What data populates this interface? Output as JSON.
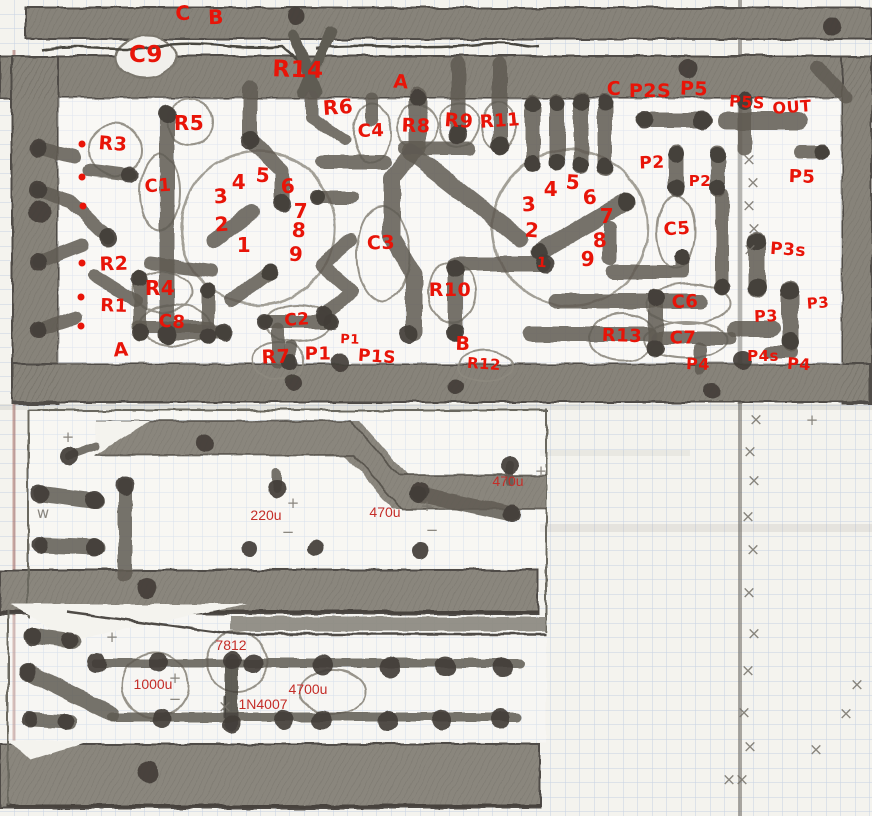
{
  "meta": {
    "description": "Hand-drawn PCB copper trace layout sketch on blue graph paper, pencil traces with red component annotations"
  },
  "colors": {
    "paper": "#f4f3ee",
    "grid_blue": "#b7c6df",
    "pencil_gray": "#5f5b52",
    "pencil_dark": "#423e38",
    "handwritten_red": "#e81408",
    "typed_red": "#c42d28",
    "margin_line": "#9b5a50"
  },
  "component_labels": [
    {
      "text": "C",
      "x": 183,
      "y": 13,
      "size": 20
    },
    {
      "text": "B",
      "x": 216,
      "y": 17,
      "size": 20
    },
    {
      "text": "C9",
      "x": 146,
      "y": 55,
      "size": 23
    },
    {
      "text": "R14",
      "x": 298,
      "y": 70,
      "size": 23
    },
    {
      "text": "A",
      "x": 401,
      "y": 82,
      "size": 19
    },
    {
      "text": "R6",
      "x": 338,
      "y": 107,
      "size": 20
    },
    {
      "text": "C4",
      "x": 371,
      "y": 131,
      "size": 18
    },
    {
      "text": "R5",
      "x": 189,
      "y": 123,
      "size": 20
    },
    {
      "text": "R8",
      "x": 416,
      "y": 126,
      "size": 19
    },
    {
      "text": "R9",
      "x": 459,
      "y": 121,
      "size": 19
    },
    {
      "text": "R11",
      "x": 500,
      "y": 121,
      "size": 18
    },
    {
      "text": "C",
      "x": 614,
      "y": 89,
      "size": 19
    },
    {
      "text": "P2S",
      "x": 650,
      "y": 91,
      "size": 19
    },
    {
      "text": "P5",
      "x": 694,
      "y": 89,
      "size": 19
    },
    {
      "text": "P5S",
      "x": 747,
      "y": 102,
      "size": 16
    },
    {
      "text": "OUT",
      "x": 792,
      "y": 107,
      "size": 16
    },
    {
      "text": "P2",
      "x": 652,
      "y": 163,
      "size": 17
    },
    {
      "text": "P2",
      "x": 700,
      "y": 181,
      "size": 15
    },
    {
      "text": "P5",
      "x": 802,
      "y": 177,
      "size": 18
    },
    {
      "text": "R3",
      "x": 113,
      "y": 144,
      "size": 19
    },
    {
      "text": "C1",
      "x": 158,
      "y": 186,
      "size": 18
    },
    {
      "text": "R2",
      "x": 114,
      "y": 264,
      "size": 19
    },
    {
      "text": "R4",
      "x": 160,
      "y": 288,
      "size": 20
    },
    {
      "text": "R1",
      "x": 114,
      "y": 306,
      "size": 18
    },
    {
      "text": "C8",
      "x": 172,
      "y": 322,
      "size": 18
    },
    {
      "text": "A",
      "x": 121,
      "y": 350,
      "size": 19
    },
    {
      "text": "R7",
      "x": 276,
      "y": 357,
      "size": 19
    },
    {
      "text": "P1",
      "x": 318,
      "y": 354,
      "size": 18
    },
    {
      "text": "P1",
      "x": 350,
      "y": 340,
      "size": 13
    },
    {
      "text": "P1S",
      "x": 377,
      "y": 357,
      "size": 17
    },
    {
      "text": "C2",
      "x": 297,
      "y": 320,
      "size": 17
    },
    {
      "text": "C3",
      "x": 381,
      "y": 243,
      "size": 19
    },
    {
      "text": "R10",
      "x": 450,
      "y": 290,
      "size": 19
    },
    {
      "text": "B",
      "x": 463,
      "y": 344,
      "size": 19
    },
    {
      "text": "R12",
      "x": 484,
      "y": 364,
      "size": 15
    },
    {
      "text": "C5",
      "x": 677,
      "y": 229,
      "size": 18
    },
    {
      "text": "C6",
      "x": 685,
      "y": 302,
      "size": 18
    },
    {
      "text": "C7",
      "x": 683,
      "y": 338,
      "size": 18
    },
    {
      "text": "R13",
      "x": 622,
      "y": 336,
      "size": 18
    },
    {
      "text": "P3s",
      "x": 788,
      "y": 250,
      "size": 17
    },
    {
      "text": "P3",
      "x": 818,
      "y": 303,
      "size": 15
    },
    {
      "text": "P3",
      "x": 766,
      "y": 316,
      "size": 16
    },
    {
      "text": "P4s",
      "x": 763,
      "y": 356,
      "size": 15
    },
    {
      "text": "P4",
      "x": 698,
      "y": 364,
      "size": 16
    },
    {
      "text": "P4",
      "x": 799,
      "y": 364,
      "size": 16
    }
  ],
  "pin_labels": [
    {
      "text": "3",
      "x": 221,
      "y": 196
    },
    {
      "text": "4",
      "x": 239,
      "y": 182
    },
    {
      "text": "5",
      "x": 263,
      "y": 175
    },
    {
      "text": "6",
      "x": 288,
      "y": 186
    },
    {
      "text": "7",
      "x": 301,
      "y": 211
    },
    {
      "text": "8",
      "x": 299,
      "y": 230
    },
    {
      "text": "2",
      "x": 222,
      "y": 224
    },
    {
      "text": "1",
      "x": 244,
      "y": 245
    },
    {
      "text": "9",
      "x": 296,
      "y": 254
    },
    {
      "text": "3",
      "x": 529,
      "y": 204
    },
    {
      "text": "4",
      "x": 551,
      "y": 189
    },
    {
      "text": "5",
      "x": 573,
      "y": 182
    },
    {
      "text": "6",
      "x": 590,
      "y": 197
    },
    {
      "text": "7",
      "x": 607,
      "y": 216
    },
    {
      "text": "2",
      "x": 532,
      "y": 230
    },
    {
      "text": "8",
      "x": 600,
      "y": 240
    },
    {
      "text": "9",
      "x": 588,
      "y": 259
    },
    {
      "text": "1",
      "x": 542,
      "y": 263,
      "size": 14
    }
  ],
  "value_labels": [
    {
      "text": "470u",
      "x": 508,
      "y": 481
    },
    {
      "text": "220u",
      "x": 266,
      "y": 515
    },
    {
      "text": "470u",
      "x": 385,
      "y": 512
    },
    {
      "text": "7812",
      "x": 231,
      "y": 645
    },
    {
      "text": "1000u",
      "x": 153,
      "y": 684
    },
    {
      "text": "4700u",
      "x": 308,
      "y": 689
    },
    {
      "text": "1N4007",
      "x": 263,
      "y": 704
    }
  ],
  "red_dots": [
    {
      "x": 82,
      "y": 144
    },
    {
      "x": 82,
      "y": 177
    },
    {
      "x": 83,
      "y": 206
    },
    {
      "x": 82,
      "y": 263
    },
    {
      "x": 81,
      "y": 297
    },
    {
      "x": 81,
      "y": 326
    }
  ],
  "pencil_marks": [
    {
      "glyph": "+",
      "x": 68,
      "y": 437
    },
    {
      "glyph": "+",
      "x": 293,
      "y": 503
    },
    {
      "glyph": "+",
      "x": 427,
      "y": 506
    },
    {
      "glyph": "+",
      "x": 541,
      "y": 471
    },
    {
      "glyph": "+",
      "x": 175,
      "y": 678
    },
    {
      "glyph": "+",
      "x": 112,
      "y": 637
    },
    {
      "glyph": "−",
      "x": 288,
      "y": 532
    },
    {
      "glyph": "−",
      "x": 432,
      "y": 530
    },
    {
      "glyph": "−",
      "x": 175,
      "y": 699
    },
    {
      "glyph": "w",
      "x": 43,
      "y": 513
    },
    {
      "glyph": "×",
      "x": 225,
      "y": 707
    },
    {
      "glyph": "×",
      "x": 749,
      "y": 160
    },
    {
      "glyph": "×",
      "x": 753,
      "y": 183
    },
    {
      "glyph": "×",
      "x": 749,
      "y": 206
    },
    {
      "glyph": "×",
      "x": 754,
      "y": 229
    },
    {
      "glyph": "×",
      "x": 750,
      "y": 250
    },
    {
      "glyph": "×",
      "x": 757,
      "y": 272
    },
    {
      "glyph": "×",
      "x": 756,
      "y": 420
    },
    {
      "glyph": "×",
      "x": 750,
      "y": 452
    },
    {
      "glyph": "×",
      "x": 754,
      "y": 481
    },
    {
      "glyph": "×",
      "x": 748,
      "y": 517
    },
    {
      "glyph": "×",
      "x": 753,
      "y": 550
    },
    {
      "glyph": "×",
      "x": 749,
      "y": 593
    },
    {
      "glyph": "×",
      "x": 754,
      "y": 634
    },
    {
      "glyph": "×",
      "x": 748,
      "y": 671
    },
    {
      "glyph": "×",
      "x": 744,
      "y": 713
    },
    {
      "glyph": "×",
      "x": 750,
      "y": 747
    },
    {
      "glyph": "×",
      "x": 742,
      "y": 780
    },
    {
      "glyph": "×",
      "x": 846,
      "y": 714
    },
    {
      "glyph": "×",
      "x": 816,
      "y": 750
    },
    {
      "glyph": "×",
      "x": 729,
      "y": 780
    },
    {
      "glyph": "×",
      "x": 857,
      "y": 685
    },
    {
      "glyph": "+",
      "x": 812,
      "y": 420
    }
  ]
}
